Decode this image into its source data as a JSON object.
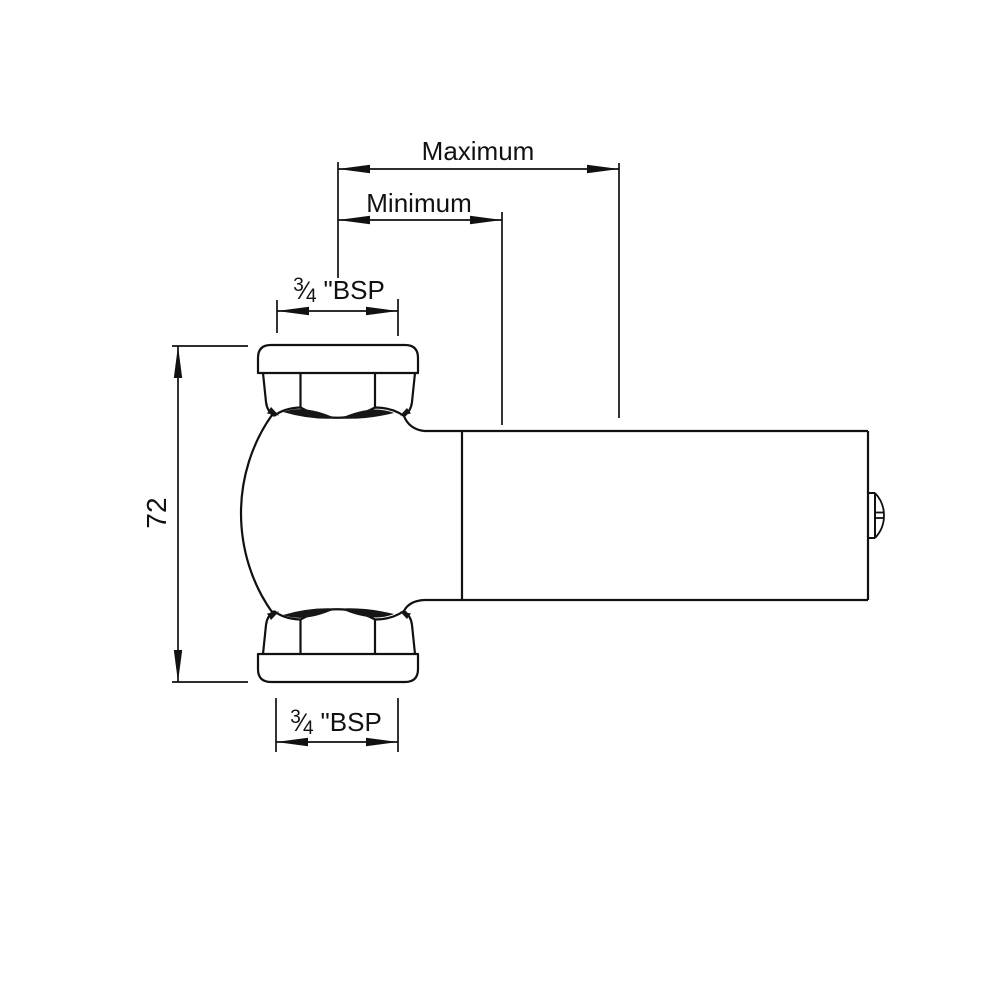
{
  "page": {
    "background": "#ffffff"
  },
  "drawing": {
    "type": "technical-dimension-drawing",
    "subject": "angled valve with two hex union nuts and horizontal telescopic barrel",
    "line_color": "#111111",
    "labels": {
      "maximum": "Maximum",
      "minimum": "Minimum",
      "height": "72",
      "thread_top": {
        "numerator": "3",
        "slash": "⁄",
        "denominator": "4",
        "suffix": "\"BSP"
      },
      "thread_bottom": {
        "numerator": "3",
        "slash": "⁄",
        "denominator": "4",
        "suffix": "\"BSP"
      }
    }
  }
}
